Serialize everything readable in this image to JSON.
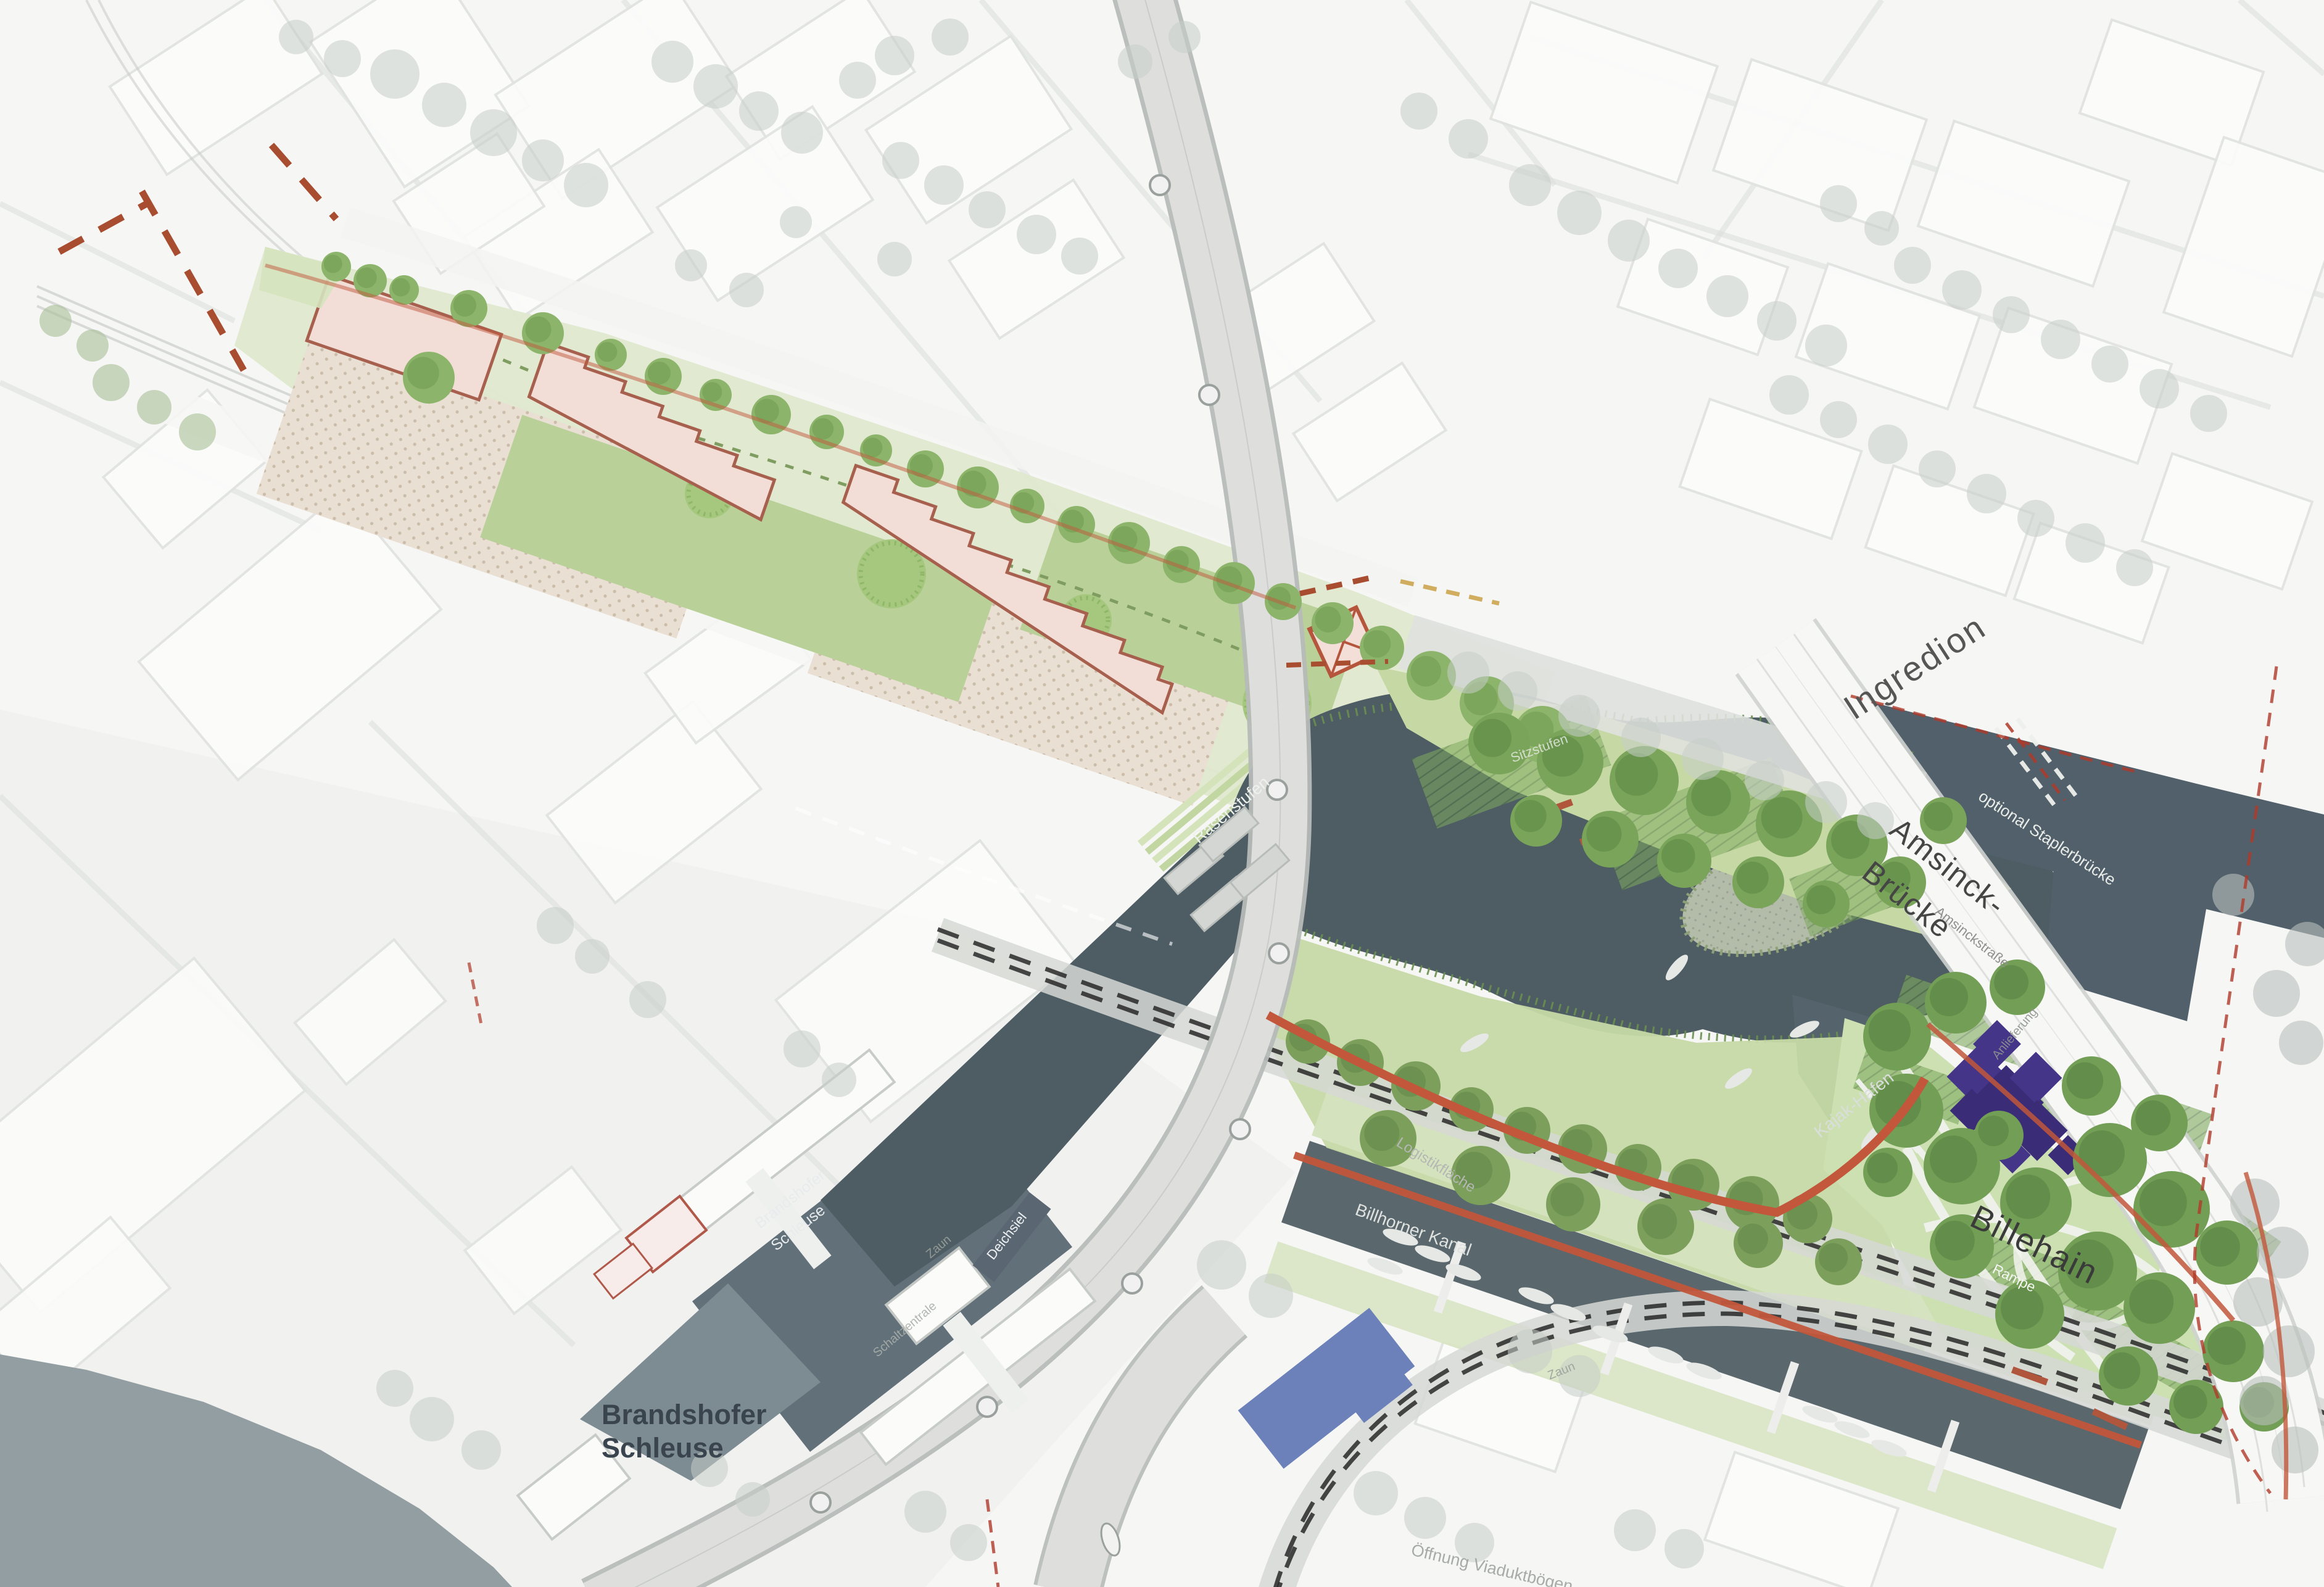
{
  "map": {
    "type": "landscape-masterplan-site-plan",
    "labels": {
      "ingredion": "Ingredion",
      "amsinck1": "Amsinck-",
      "amsinck2": "Brücke",
      "amsinckstrasse": "Amsinckstraße",
      "staplerbruecke": "optional Staplerbrücke",
      "billehain": "Billehain",
      "rampe": "Rampe",
      "kajak_hafen": "Kajak-Hafen",
      "billhorner_kanal": "Billhorner Kanal",
      "logistikflaeche": "Logistikfläche",
      "rasenstufen": "Rasenstufen",
      "sitzstufen": "Sitzstufen",
      "schleuse_small1": "Brandshofer",
      "schleuse_small2": "Schleuse",
      "schleuse_title1": "Brandshofer",
      "schleuse_title2": "Schleuse",
      "deichsiel": "Deichsiel",
      "zaun_a": "Zaun",
      "zaun_b": "Zaun",
      "schaltzentrale": "Schaltzentrale",
      "oeffnung_viadukt": "Öffnung Viaduktbögen",
      "anlieferung": "Anlieferung"
    },
    "colors": {
      "paper": "#f6f6f5",
      "water_dark": "#4e5d64",
      "water_river": "#939ea3",
      "park_green": "#cde0b2",
      "strip_green": "#dfe8cd",
      "bank_green": "#c6d9a5",
      "tree_bright": "#8db46b",
      "tree_bright_dark": "#6f9a50",
      "tree_park": "#729e55",
      "tree_park_dark": "#587f42",
      "tree_faded": "#c7cdc9",
      "tree_greygreen": "#a9bf96",
      "building_rose_fill": "#f2ddd7",
      "building_rose_stroke": "#a7604d",
      "building_purple": "#453589",
      "building_blue": "#6c80ba",
      "plaza_dotted": "#e9dfd3",
      "plaza_dot": "#c4b49e",
      "path_terracotta": "#c2573b",
      "axis_red_dash": "#a84d30",
      "boundary_red": "#b03a2a",
      "rail_black": "#1d1d1d",
      "road_grey": "#dedfdd",
      "road_edge": "#b6bbb8",
      "block_fill": "#fcfcfb",
      "block_stroke": "#e0e3e0",
      "label_dark": "#3a3a3a",
      "label_bold_slate": "#3a444e",
      "label_light": "#eef1ec"
    }
  }
}
